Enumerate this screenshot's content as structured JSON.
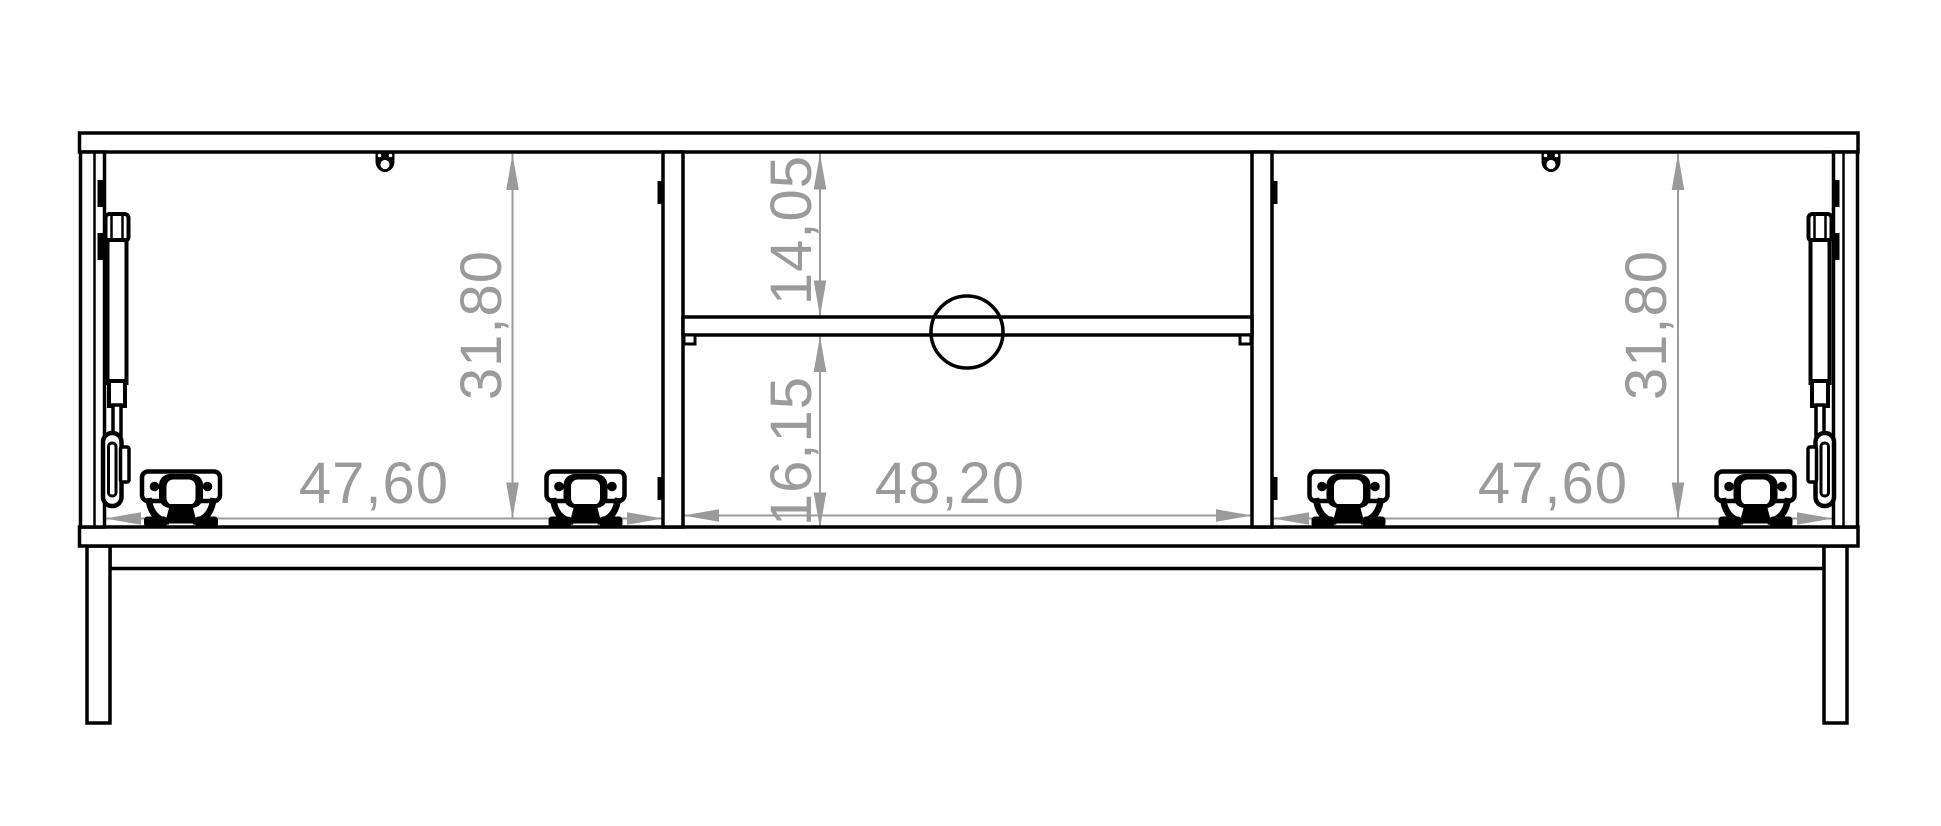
{
  "drawing": {
    "kind": "furniture-front-view-technical-drawing",
    "colors": {
      "line": "#000000",
      "dimension": "#9b9b9b",
      "background": "#ffffff"
    },
    "dims": {
      "left_width": "47,60",
      "left_height": "31,80",
      "mid_upper_height": "14,05",
      "mid_lower_height": "16,15",
      "mid_width": "48,20",
      "right_width": "47,60",
      "right_height": "31,80"
    }
  }
}
